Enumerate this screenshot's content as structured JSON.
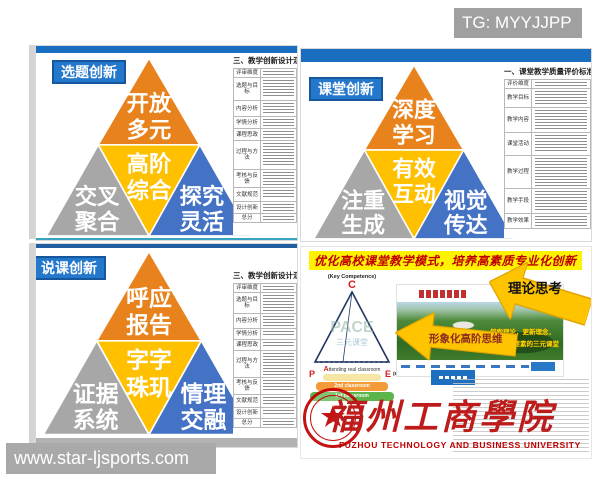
{
  "watermark_top": "TG: MYYJJPP",
  "watermark_bottom": "www.star-ljsports.com",
  "slide_topic": {
    "label": "选题创新",
    "tiers": {
      "top": [
        "开放",
        "多元"
      ],
      "mid": [
        "高阶",
        "综合"
      ],
      "left": [
        "交叉",
        "聚合"
      ],
      "right": [
        "探究",
        "灵活"
      ]
    },
    "table": {
      "title": "三、教学创新设计汇报",
      "header": "评审维度",
      "rows": [
        "选题与目标",
        "内容分析",
        "学情分析",
        "课程思政",
        "过程与方法",
        "考核与反馈",
        "文献规范",
        "设计创新",
        "总分"
      ]
    }
  },
  "slide_classroom": {
    "label": "课堂创新",
    "tiers": {
      "top": [
        "深度",
        "学习"
      ],
      "mid": [
        "有效",
        "互动"
      ],
      "left": [
        "注重",
        "生成"
      ],
      "right": [
        "视觉",
        "传达"
      ]
    },
    "table": {
      "title": "一、课堂教学质量评价标准",
      "header": "评价维度",
      "rows": [
        "教学目标",
        "教学内容",
        "课堂活动",
        "教学过程",
        "教学手段",
        "教学效果"
      ]
    }
  },
  "slide_lesson": {
    "label": "说课创新",
    "tiers": {
      "top": [
        "呼应",
        "报告"
      ],
      "mid": [
        "字字",
        "珠玑"
      ],
      "left": [
        "证据",
        "系统"
      ],
      "right": [
        "情理",
        "交融"
      ]
    },
    "table": {
      "title": "三、教学创新设计汇报",
      "header": "评审维度",
      "rows": [
        "选题与目标",
        "内容分析",
        "学情分析",
        "课程思政",
        "过程与方法",
        "考核与反馈",
        "文献规范",
        "设计创新",
        "总分"
      ]
    }
  },
  "slide_summary": {
    "title": "优化高校课堂教学模式，培养高素质专业化创新",
    "arrow_theory": "理论思考",
    "arrow_thinking": "形象化高阶思维",
    "banner_line1": "探索理论，更新理念，",
    "banner_line2": "借鉴PACE要素的三元课堂",
    "pace": {
      "key_label": "(Key Competence)",
      "c": "C",
      "p": "P",
      "a": "A",
      "e": "E",
      "eval_label": "(Evaluation)",
      "attending": "ttending real classroom",
      "watermark_big": "PACE",
      "watermark_small": "三元课堂",
      "layer2": "2nd classroom",
      "layer1": "1st classroom"
    },
    "university_cn": "福州工商學院",
    "university_en": "FUZHOU TECHNOLOGY AND BUSINESS UNIVERSITY"
  },
  "colors": {
    "tier_orange": "#E8821D",
    "tier_yellow": "#FFC000",
    "tier_gray": "#A7A7A7",
    "tier_blue": "#4472C4",
    "bar_blue": "#1A6EC0",
    "label_blue": "#2478CC",
    "brand_red": "#C00000",
    "arrow_yellow": "#FFC400"
  }
}
